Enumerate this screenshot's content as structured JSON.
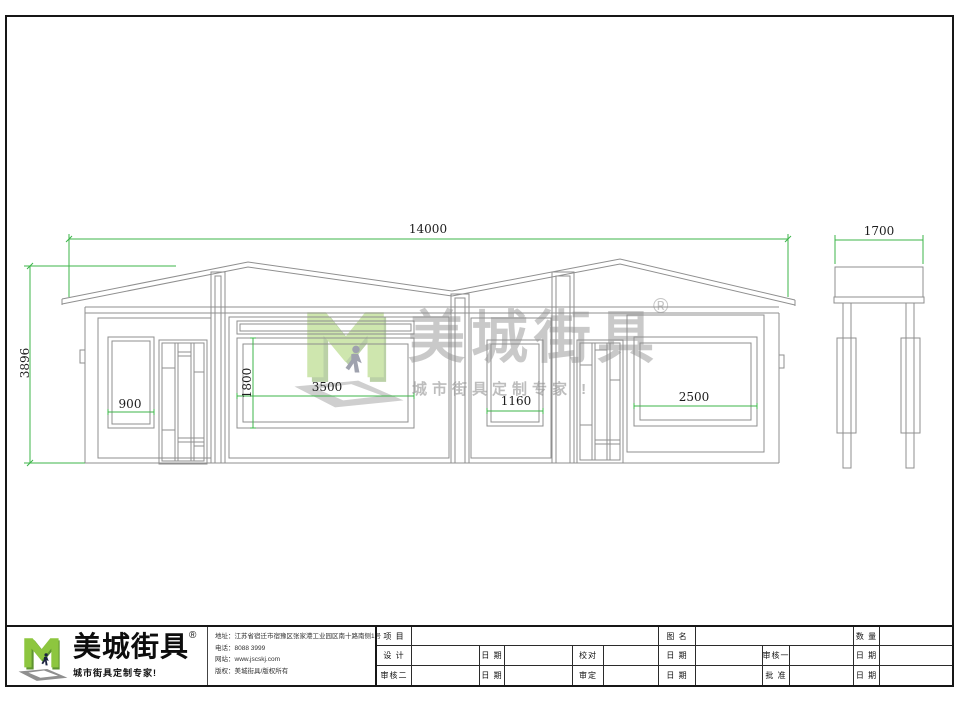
{
  "drawing": {
    "dimensions": {
      "overall_width": "14000",
      "overall_height": "3896",
      "side_width": "1700",
      "left_window_width": "900",
      "main_window_height": "1800",
      "main_window_width": "3500",
      "center_window_width": "1160",
      "right_window_width": "2500"
    },
    "colors": {
      "dimension_green": "#3cb549",
      "line_gray": "#8f8f8f",
      "logo_green": "#8dc63f"
    }
  },
  "watermark": {
    "brand": "美城街具",
    "registered": "®",
    "tagline": "城市街具定制专家 !"
  },
  "title_block": {
    "logo": {
      "brand": "美城街具",
      "registered": "®",
      "tagline": "城市街具定制专家!"
    },
    "company": {
      "address": "地址：江苏省宿迁市宿豫区张家港工业园区南十路南侧1号",
      "phone": "电话：8088 3999",
      "website": "网站：www.jscskj.com",
      "copyright": "版权：美城街具/版权所有"
    },
    "labels": {
      "project": "项 目",
      "drawing_name": "图 名",
      "quantity": "数 量",
      "design": "设 计",
      "date": "日 期",
      "proofread": "校对",
      "reviewer1": "审核一",
      "reviewer2": "审核二",
      "final_approval": "审定",
      "approval": "批 准"
    }
  }
}
